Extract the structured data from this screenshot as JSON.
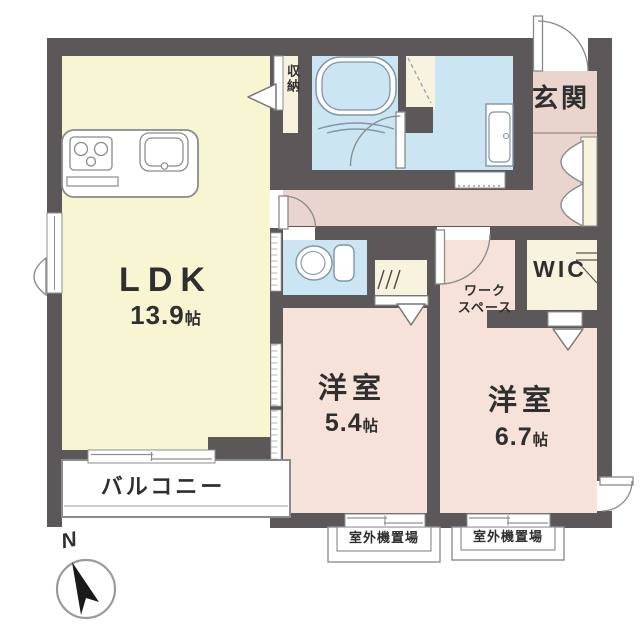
{
  "rooms": {
    "ldk": {
      "label": "LDK",
      "size": "13.9",
      "size_unit": "帖"
    },
    "bedroom_small": {
      "label": "洋室",
      "size": "5.4",
      "size_unit": "帖"
    },
    "bedroom_large": {
      "label": "洋室",
      "size": "6.7",
      "size_unit": "帖"
    },
    "entrance": {
      "label": "玄関"
    },
    "wic": {
      "label": "WIC"
    },
    "storage": {
      "label": "収納"
    },
    "workspace": {
      "label_line1": "ワーク",
      "label_line2": "スペース"
    },
    "balcony": {
      "label": "バルコニー"
    },
    "outdoor_unit_left": {
      "label": "室外機置場"
    },
    "outdoor_unit_right": {
      "label": "室外機置場"
    }
  },
  "compass": {
    "north_label": "N"
  },
  "symbols": [
    "kitchen-stove-icon",
    "kitchen-sink-icon",
    "bathtub-icon",
    "toilet-icon",
    "vanity-icon",
    "compass-icon",
    "door-swing-icon",
    "sliding-window-icon",
    "folding-door-arrow-icon",
    "hanger-pipe-icon"
  ],
  "colors": {
    "wall": "#5c5859",
    "ldk": "#f8f5d2",
    "bedroom": "#f6e2d9",
    "hall": "#e9d4ce",
    "wet": "#cbe5f2",
    "closet": "#f7f3df",
    "fixture": "#7f95a8",
    "text": "#2f2f2f"
  }
}
